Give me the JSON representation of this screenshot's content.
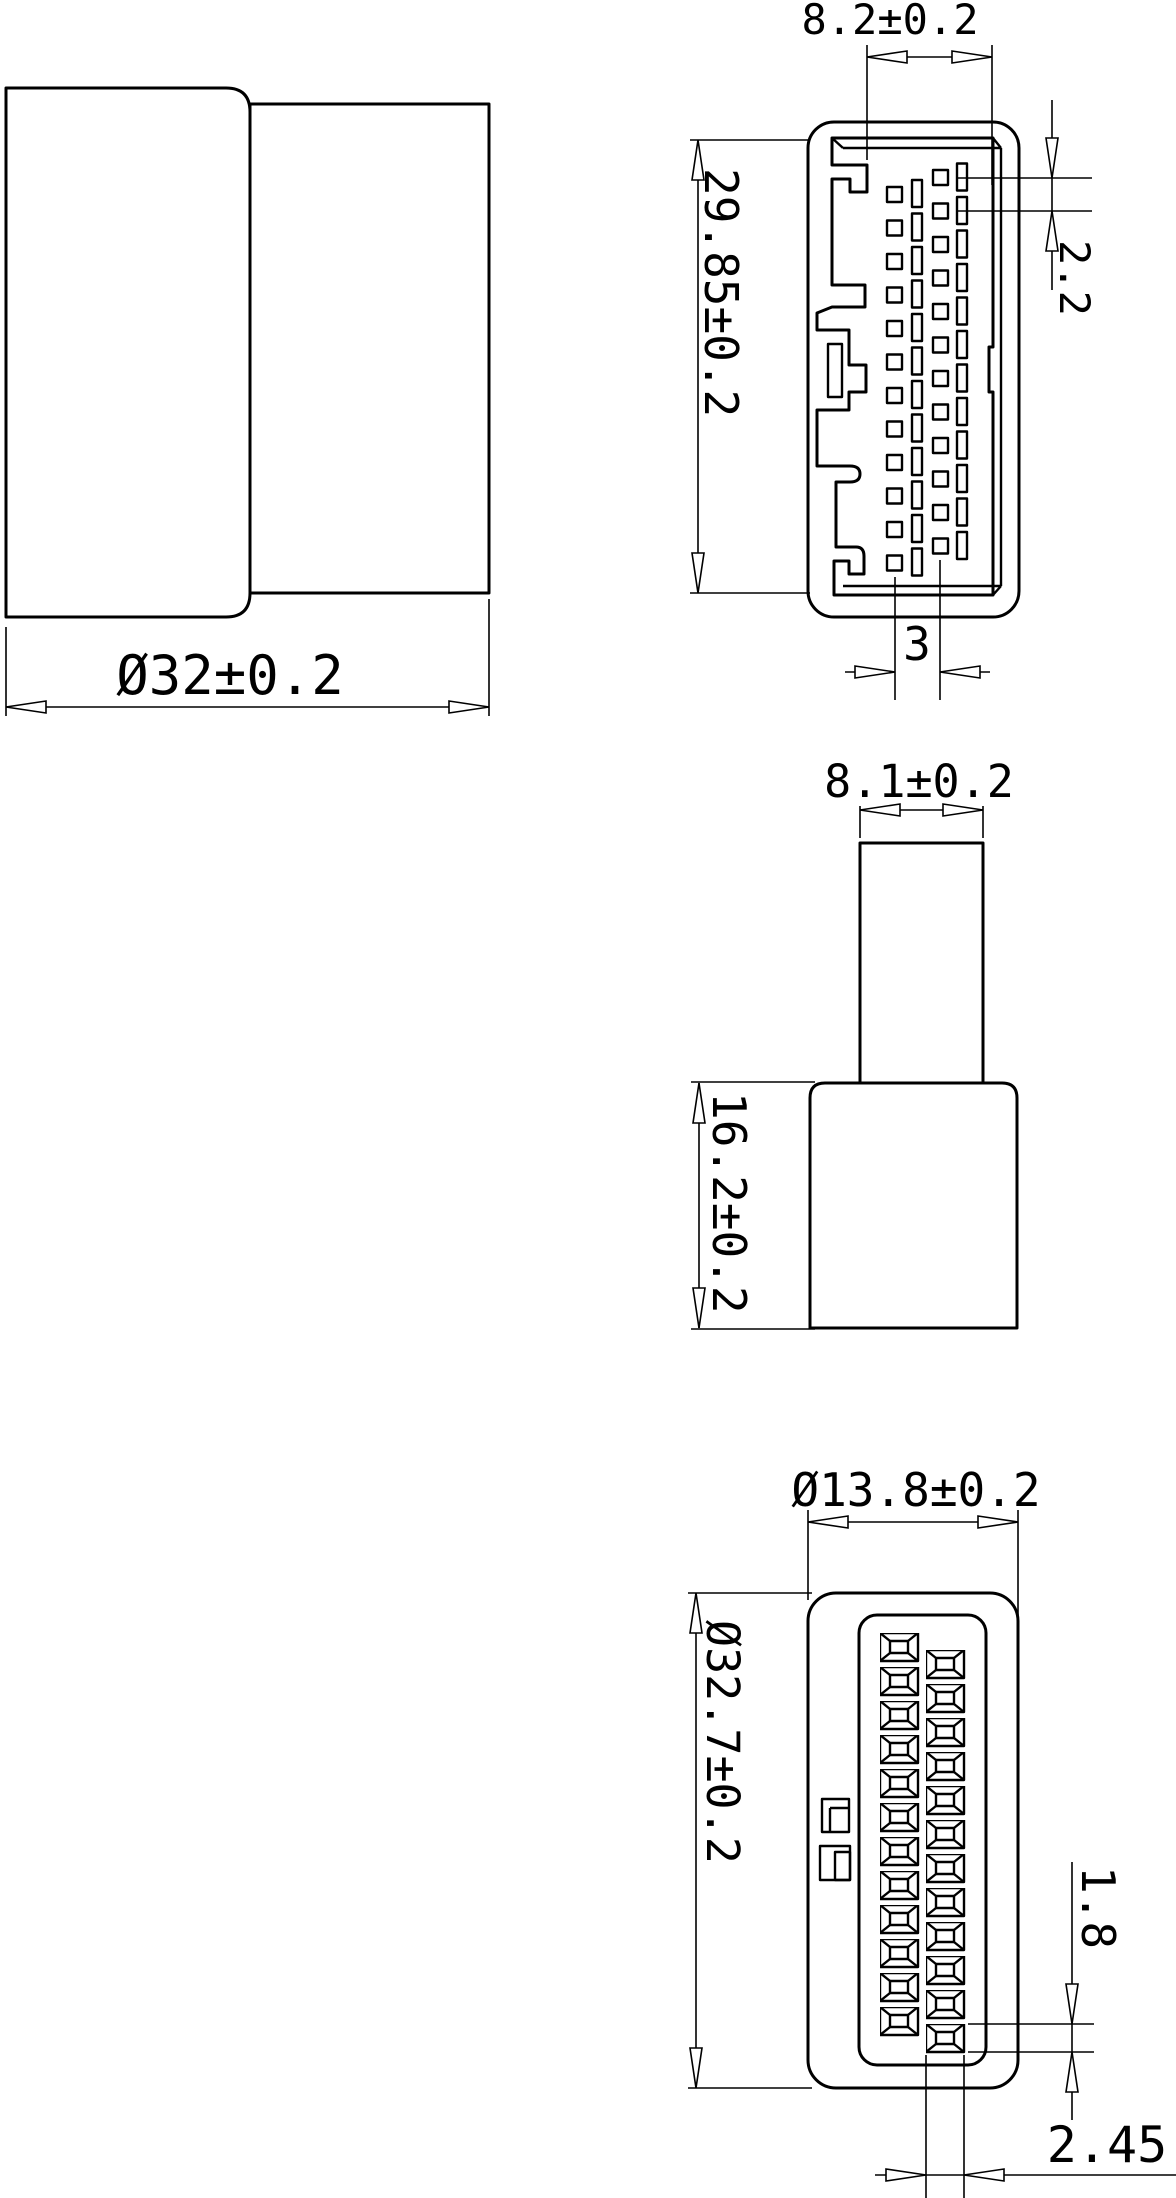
{
  "drawing": {
    "background_color": "#ffffff",
    "line_color": "#000000",
    "side_view": {
      "width_dim": "Ø32±0.2"
    },
    "front_view": {
      "slot_width_dim": "8.2±0.2",
      "height_dim": "29.85±0.2",
      "row_pitch_dim": "2.2",
      "column_spacing_dim": "3",
      "pin_rows": 12,
      "pin_columns": 4
    },
    "profile_view": {
      "stem_width_dim": "8.1±0.2",
      "body_height_dim": "16.2±0.2"
    },
    "rear_view": {
      "width_dim": "Ø13.8±0.2",
      "height_dim": "Ø32.7±0.2",
      "terminal_height_dim": "1.8",
      "terminal_width_dim": "2.45",
      "terminal_rows": 12,
      "terminal_columns": 2
    }
  }
}
